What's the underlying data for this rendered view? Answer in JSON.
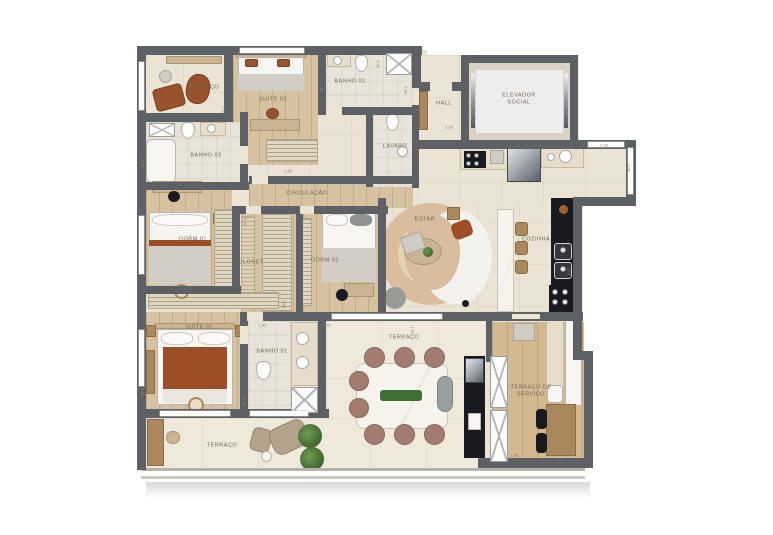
{
  "plan": {
    "type": "apartment-floor-plan",
    "colors": {
      "wall": "#5d6165",
      "floor_tile": "#ebe3d4",
      "floor_wood": "#d6c2a0",
      "furniture_brown": "#99522e",
      "furniture_rust": "#9c4f26",
      "kitchen_unit_black": "#191920",
      "plant_green": "#4e7d3a",
      "marble": "#f5f2ec"
    }
  },
  "rooms": [
    {
      "id": "terraco-top",
      "label": "TERRAÇO",
      "x": 204,
      "y": 88
    },
    {
      "id": "suite-02",
      "label": "SUÍTE 02",
      "x": 273,
      "y": 100
    },
    {
      "id": "banho-02",
      "label": "BANHO 02",
      "x": 350,
      "y": 82
    },
    {
      "id": "hall",
      "label": "HALL",
      "x": 444,
      "y": 104
    },
    {
      "id": "elevador-social",
      "label": "ELEVADOR SOCIAL",
      "x": 519,
      "y": 100,
      "w": 42
    },
    {
      "id": "banho-03",
      "label": "BANHO 03",
      "x": 206,
      "y": 156
    },
    {
      "id": "lavabo",
      "label": "LAVABO",
      "x": 395,
      "y": 147
    },
    {
      "id": "circulacao",
      "label": "CIRCULAÇÃO",
      "x": 307,
      "y": 194
    },
    {
      "id": "dorm-01",
      "label": "DORM 01",
      "x": 193,
      "y": 240
    },
    {
      "id": "closet",
      "label": "CLOSET",
      "x": 251,
      "y": 263
    },
    {
      "id": "dorm-02",
      "label": "DORM 02",
      "x": 325,
      "y": 261
    },
    {
      "id": "estar",
      "label": "ESTAR",
      "x": 425,
      "y": 220
    },
    {
      "id": "cozinha",
      "label": "COZINHA",
      "x": 536,
      "y": 240
    },
    {
      "id": "suite-01",
      "label": "SUÍTE 01",
      "x": 199,
      "y": 328
    },
    {
      "id": "banho-01",
      "label": "BANHO 01",
      "x": 272,
      "y": 352
    },
    {
      "id": "terraco-main",
      "label": "TERRAÇO",
      "x": 404,
      "y": 338
    },
    {
      "id": "terraco-servico",
      "label": "TERRAÇO DE SERVIÇO",
      "x": 531,
      "y": 392,
      "w": 44
    },
    {
      "id": "terraco-bottom",
      "label": "TERRAÇO",
      "x": 222,
      "y": 446
    }
  ],
  "dimensions": [
    {
      "text": "2.38",
      "x": 224,
      "y": 110,
      "rot": 90
    },
    {
      "text": "2.40",
      "x": 378,
      "y": 64,
      "rot": 90
    },
    {
      "text": "1.95",
      "x": 322,
      "y": 88,
      "rot": 90
    },
    {
      "text": "2.60",
      "x": 406,
      "y": 90,
      "rot": 90
    },
    {
      "text": "1.50",
      "x": 449,
      "y": 127,
      "rot": 0
    },
    {
      "text": "3.53",
      "x": 143,
      "y": 163,
      "rot": 90
    },
    {
      "text": "2.55",
      "x": 288,
      "y": 171,
      "rot": 0
    },
    {
      "text": "9.28",
      "x": 604,
      "y": 145,
      "rot": 0
    },
    {
      "text": "3.08",
      "x": 629,
      "y": 168,
      "rot": 90
    },
    {
      "text": "5.30",
      "x": 245,
      "y": 222,
      "rot": 90
    },
    {
      "text": "2.88",
      "x": 284,
      "y": 304,
      "rot": 90
    },
    {
      "text": "1.60",
      "x": 262,
      "y": 325,
      "rot": 0
    },
    {
      "text": "5.02",
      "x": 327,
      "y": 325,
      "rot": 0
    },
    {
      "text": "3.13",
      "x": 143,
      "y": 392,
      "rot": 90
    },
    {
      "text": "3.25",
      "x": 244,
      "y": 402,
      "rot": 90
    },
    {
      "text": "5.01",
      "x": 569,
      "y": 272,
      "rot": 90
    },
    {
      "text": "1.82",
      "x": 514,
      "y": 455,
      "rot": 0
    },
    {
      "text": "1.92",
      "x": 413,
      "y": 330,
      "rot": 90
    }
  ]
}
